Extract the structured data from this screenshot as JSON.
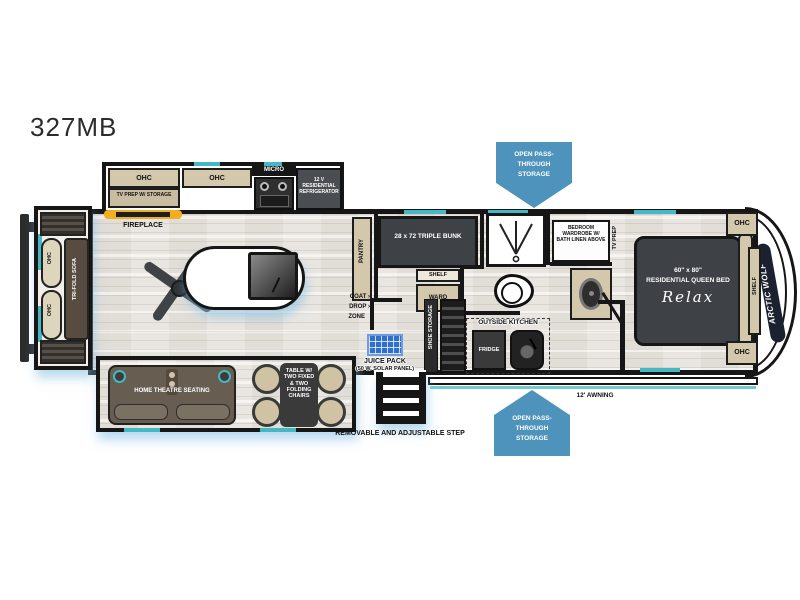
{
  "title": "327MB",
  "brand": "ARCTIC WOLF",
  "colors": {
    "callout_blue": "#4d93bc",
    "teal_accent": "#46b8c3",
    "cabinet_tan": "#d3c7ac",
    "charcoal": "#3e4247",
    "fireplace_yellow": "#f2ae1f",
    "solar_blue": "#2f6fd0"
  },
  "callouts": {
    "top": "OPEN PASS-THROUGH STORAGE",
    "bottom": "OPEN PASS-THROUGH STORAGE"
  },
  "kitchen": {
    "ohc_left": "OHC",
    "tv_prep": "TV PREP W/ STORAGE",
    "ohc_right": "OHC",
    "micro": "MICRO",
    "refrigerator": "12 V RESIDENTIAL REFRIGERATOR",
    "fireplace": "FIREPLACE"
  },
  "rear": {
    "ohc_upper": "OHC",
    "ohc_lower": "OHC",
    "sofa": "TRI-FOLD SOFA"
  },
  "living": {
    "pantry": "PANTRY",
    "coat": "COAT",
    "drop": "DROP",
    "zone": "ZONE",
    "arrow": "›"
  },
  "bunk_room": {
    "bunk": "28 x 72 TRIPLE BUNK",
    "shelf": "SHELF",
    "ward": "WARD"
  },
  "bath": {
    "wardrobe": "BEDROOM WARDROBE W/ BATH LINEN ABOVE",
    "tv_prep": "TV PREP"
  },
  "bedroom": {
    "size": "60\" x 80\"",
    "type": "RESIDENTIAL QUEEN BED",
    "brand": "Relax",
    "shelf": "SHELF",
    "ohc_upper": "OHC",
    "ohc_lower": "OHC"
  },
  "exterior": {
    "juice_pack": "JUICE PACK",
    "juice_pack_sub": "(50 W. SOLAR PANEL)",
    "shoe_storage": "SHOE STORAGE",
    "outside_kitchen": "OUTSIDE KITCHEN",
    "fridge": "FRIDGE",
    "step": "REMOVABLE AND ADJUSTABLE STEP",
    "awning": "12' AWNING"
  },
  "bottom_slide": {
    "theatre": "HOME THEATRE SEATING",
    "table": "TABLE W/ TWO FIXED & TWO FOLDING CHAIRS"
  }
}
